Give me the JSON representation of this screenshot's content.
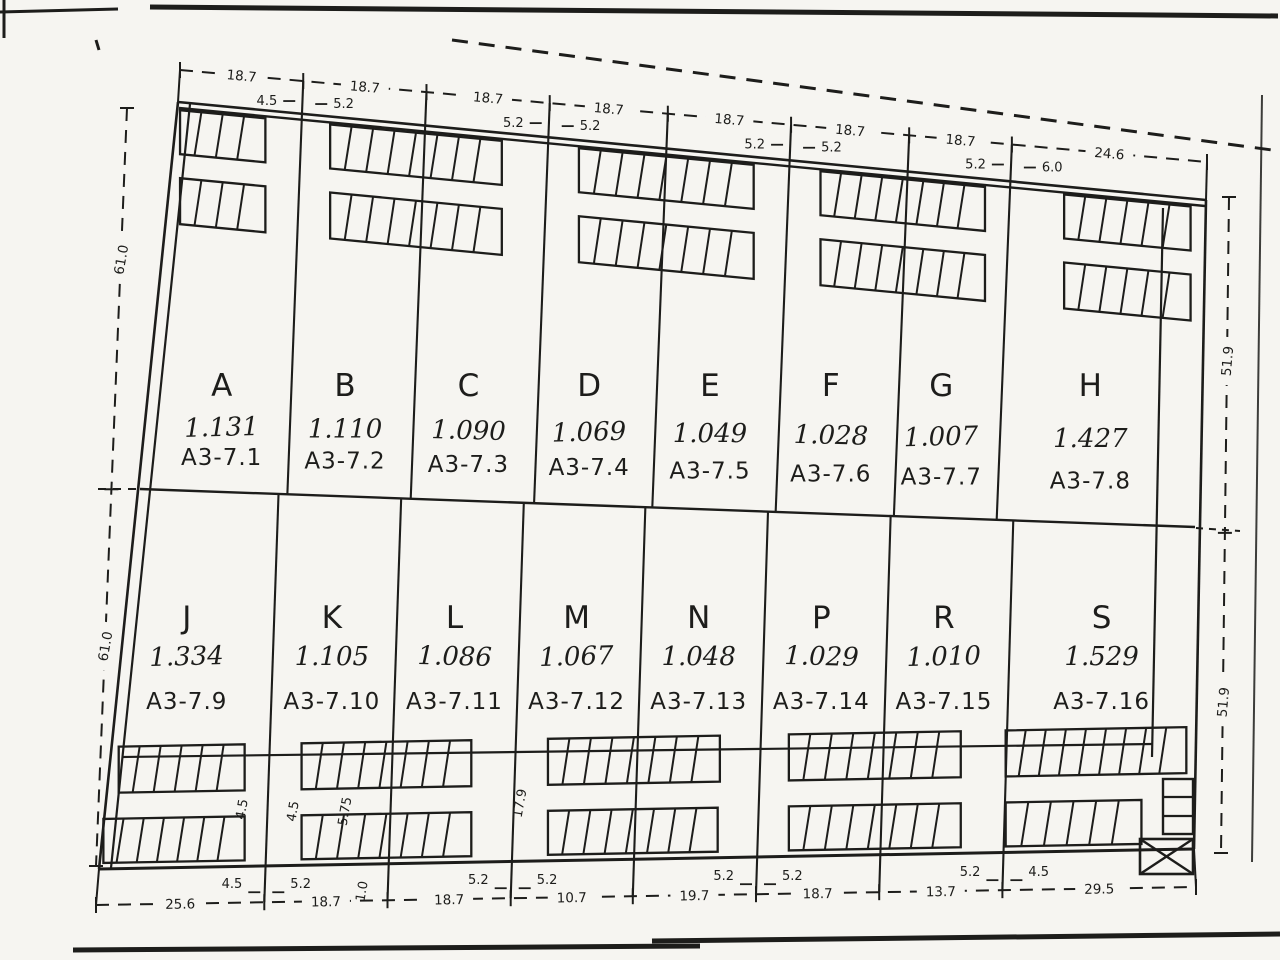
{
  "plan": {
    "lots_upper": [
      {
        "letter": "A",
        "area": "1.131",
        "code": "A3-7.1"
      },
      {
        "letter": "B",
        "area": "1.110",
        "code": "A3-7.2"
      },
      {
        "letter": "C",
        "area": "1.090",
        "code": "A3-7.3"
      },
      {
        "letter": "D",
        "area": "1.069",
        "code": "A3-7.4"
      },
      {
        "letter": "E",
        "area": "1.049",
        "code": "A3-7.5"
      },
      {
        "letter": "F",
        "area": "1.028",
        "code": "A3-7.6"
      },
      {
        "letter": "G",
        "area": "1.007",
        "code": "A3-7.7"
      },
      {
        "letter": "H",
        "area": "1.427",
        "code": "A3-7.8"
      }
    ],
    "lots_lower": [
      {
        "letter": "J",
        "area": "1.334",
        "code": "A3-7.9"
      },
      {
        "letter": "K",
        "area": "1.105",
        "code": "A3-7.10"
      },
      {
        "letter": "L",
        "area": "1.086",
        "code": "A3-7.11"
      },
      {
        "letter": "M",
        "area": "1.067",
        "code": "A3-7.12"
      },
      {
        "letter": "N",
        "area": "1.048",
        "code": "A3-7.13"
      },
      {
        "letter": "P",
        "area": "1.029",
        "code": "A3-7.14"
      },
      {
        "letter": "R",
        "area": "1.010",
        "code": "A3-7.15"
      },
      {
        "letter": "S",
        "area": "1.529",
        "code": "A3-7.16"
      }
    ],
    "dims_top": [
      "18.7",
      "18.7",
      "18.7",
      "18.7",
      "18.7",
      "18.7",
      "18.7",
      "24.6"
    ],
    "dims_top_sub": [
      [
        "4.5",
        "5.2"
      ],
      [
        "5.2",
        "5.2"
      ],
      [
        "5.2",
        "5.2"
      ],
      [
        "5.2",
        "6.0"
      ]
    ],
    "dims_bottom": [
      "25.6",
      "18.7",
      "18.7",
      "10.7",
      "19.7",
      "18.7",
      "13.7",
      "29.5"
    ],
    "dims_bottom_sub": [
      [
        "4.5",
        "5.2"
      ],
      [
        "5.2",
        "5.2"
      ],
      [
        "5.2",
        "5.2"
      ],
      [
        "5.2",
        "4.5"
      ]
    ],
    "dims_left": [
      "61.0",
      "61.0"
    ],
    "dims_right": [
      "51.9",
      "51.9"
    ],
    "dims_rotated_small": [
      "4.5",
      "4.5",
      "5.75",
      "1.0",
      "17.9"
    ],
    "ink_color": "#1d1d1b",
    "paper_color": "#f6f5f1"
  }
}
